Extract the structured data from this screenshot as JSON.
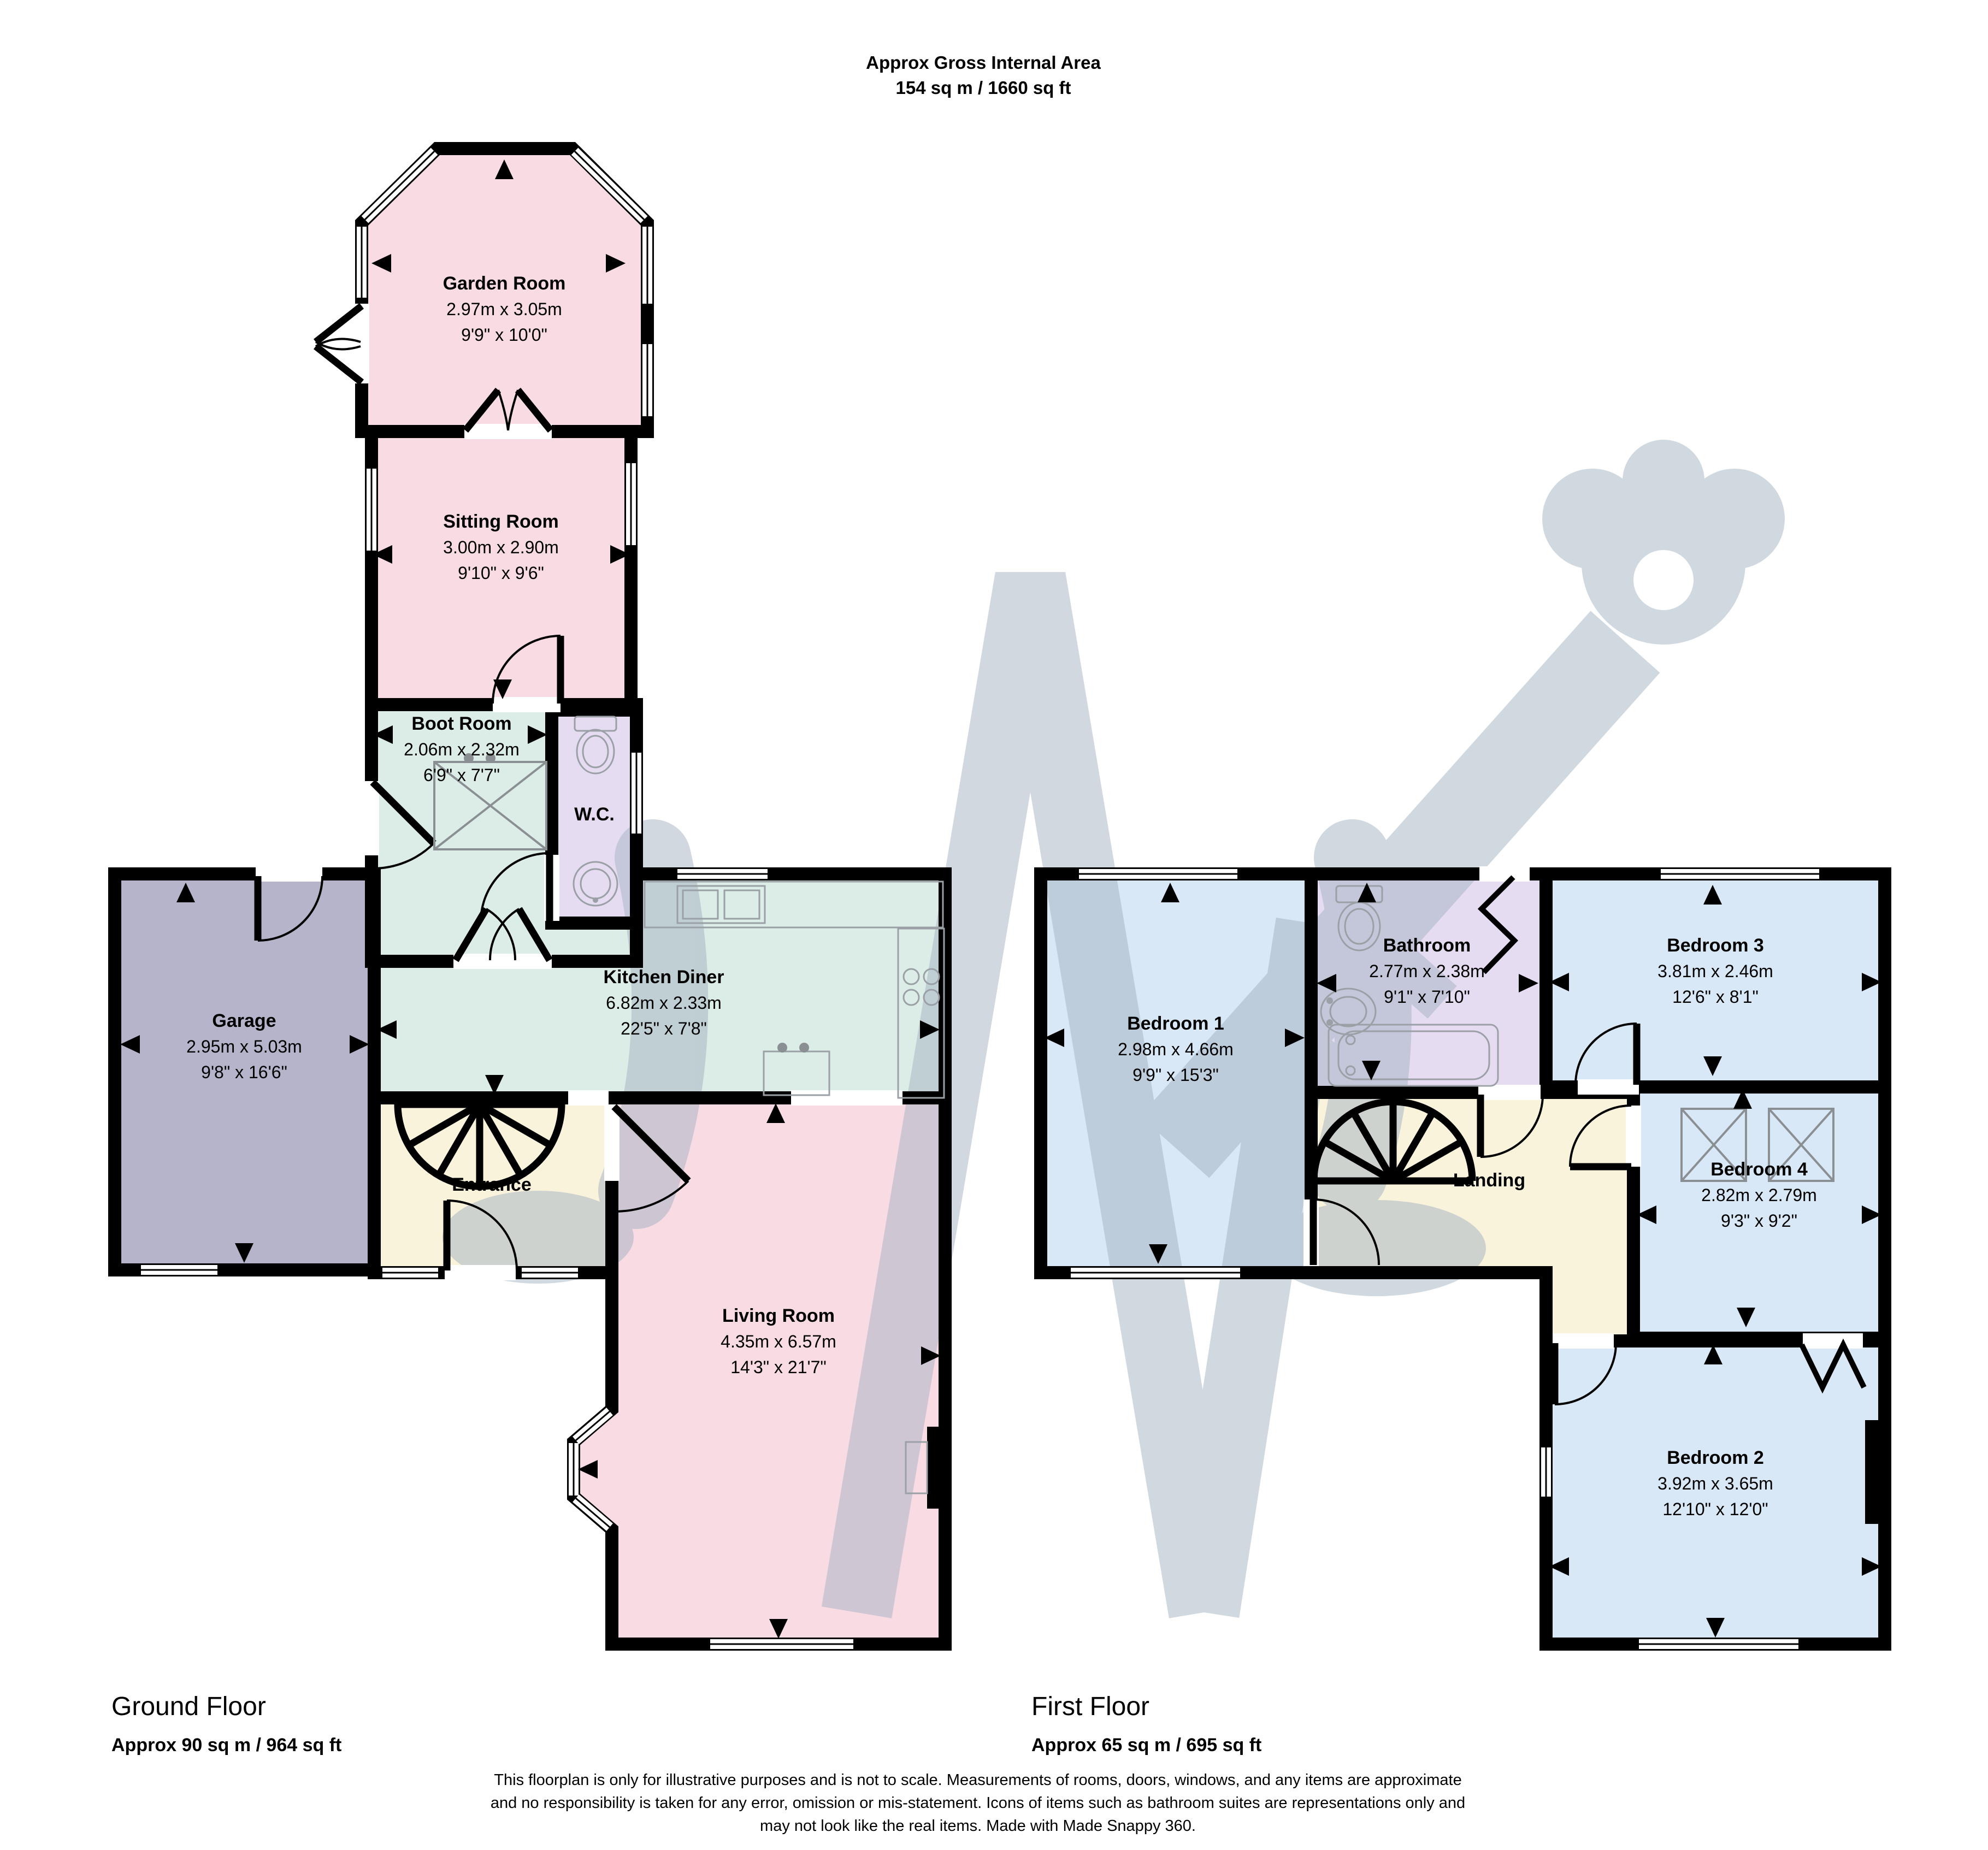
{
  "header": {
    "title": "Approx Gross Internal Area",
    "area": "154 sq m / 1660 sq ft"
  },
  "ground_floor": {
    "label": "Ground Floor",
    "area": "Approx 90 sq m / 964 sq ft",
    "rooms": {
      "garden_room": {
        "name": "Garden Room",
        "metric": "2.97m x 3.05m",
        "imperial": "9'9\" x 10'0\""
      },
      "sitting_room": {
        "name": "Sitting Room",
        "metric": "3.00m x 2.90m",
        "imperial": "9'10\" x 9'6\""
      },
      "boot_room": {
        "name": "Boot Room",
        "metric": "2.06m x 2.32m",
        "imperial": "6'9\" x 7'7\""
      },
      "wc": {
        "name": "W.C."
      },
      "garage": {
        "name": "Garage",
        "metric": "2.95m x 5.03m",
        "imperial": "9'8\" x 16'6\""
      },
      "kitchen_diner": {
        "name": "Kitchen Diner",
        "metric": "6.82m x 2.33m",
        "imperial": "22'5\" x 7'8\""
      },
      "entrance": {
        "name": "Entrance"
      },
      "living_room": {
        "name": "Living Room",
        "metric": "4.35m x 6.57m",
        "imperial": "14'3\" x 21'7\""
      }
    }
  },
  "first_floor": {
    "label": "First Floor",
    "area": "Approx 65 sq m / 695 sq ft",
    "rooms": {
      "bedroom_1": {
        "name": "Bedroom 1",
        "metric": "2.98m x 4.66m",
        "imperial": "9'9\" x 15'3\""
      },
      "bathroom": {
        "name": "Bathroom",
        "metric": "2.77m x 2.38m",
        "imperial": "9'1\" x 7'10\""
      },
      "bedroom_3": {
        "name": "Bedroom 3",
        "metric": "3.81m x 2.46m",
        "imperial": "12'6\" x 8'1\""
      },
      "bedroom_4": {
        "name": "Bedroom 4",
        "metric": "2.82m x 2.79m",
        "imperial": "9'3\" x 9'2\""
      },
      "landing": {
        "name": "Landing"
      },
      "bedroom_2": {
        "name": "Bedroom 2",
        "metric": "3.92m x 3.65m",
        "imperial": "12'10\" x 12'0\""
      }
    }
  },
  "disclaimer": {
    "line1": "This floorplan is only for illustrative purposes and is not to scale. Measurements of rooms, doors, windows, and any items are approximate",
    "line2": "and no responsibility is taken for any error, omission or mis-statement. Icons of items such as bathroom suites are representations only and",
    "line3": "may not look like the real items. Made with Made Snappy 360."
  },
  "colors": {
    "pink": "#f8dbe3",
    "mint": "#dcece6",
    "lilac": "#e6dcf2",
    "blue": "#d9e8f6",
    "cream": "#faf3dc",
    "garage_grey": "#b5b4ca",
    "wall": "#000000",
    "watermark": "#a3b2c2"
  }
}
